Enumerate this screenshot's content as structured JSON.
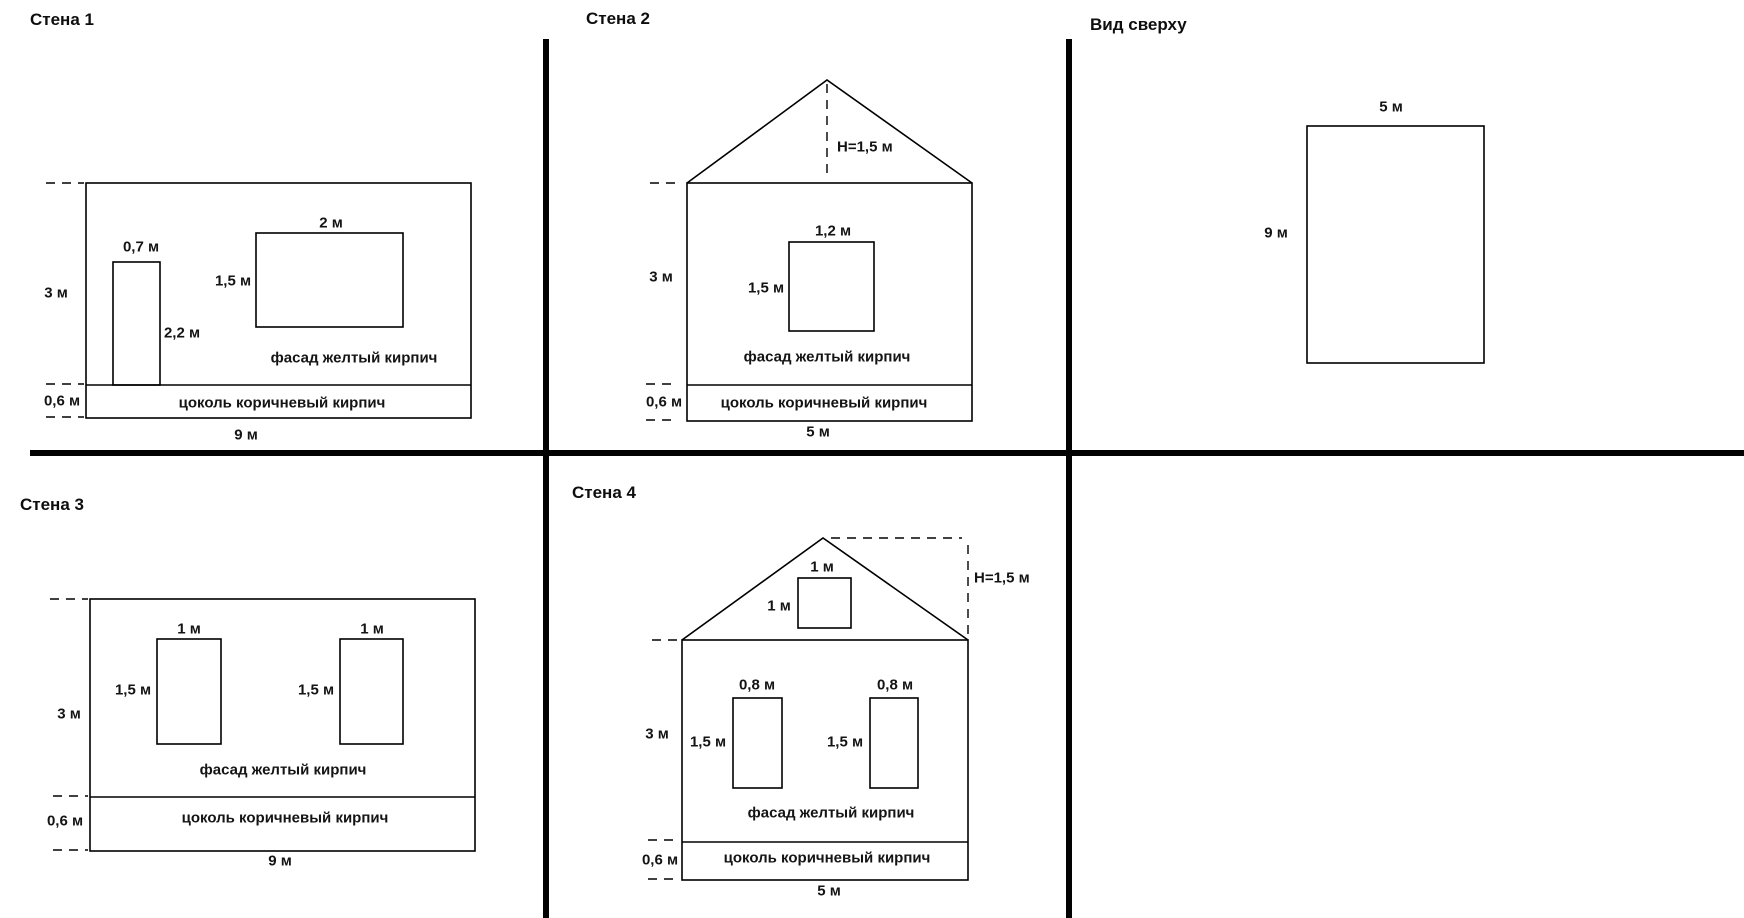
{
  "page": {
    "background": "#ffffff",
    "line_color": "#000000",
    "text_color": "#141414",
    "divider_color": "#020202"
  },
  "dividers": [
    {
      "name": "quadrant-divider-vertical-left",
      "x1": 546,
      "y1": 39,
      "x2": 546,
      "y2": 918,
      "thickness": 6
    },
    {
      "name": "quadrant-divider-vertical-right",
      "x1": 1069,
      "y1": 39,
      "x2": 1069,
      "y2": 918,
      "thickness": 6
    },
    {
      "name": "quadrant-divider-horizontal",
      "x1": 30,
      "y1": 453,
      "x2": 1744,
      "y2": 453,
      "thickness": 6
    }
  ],
  "diagrams": [
    {
      "id": "wall-1-elevation",
      "title": "Стена 1",
      "shapes": [
        {
          "type": "rect",
          "name": "wall-outline",
          "x": 86,
          "y": 183,
          "w": 385,
          "h": 235
        },
        {
          "type": "line",
          "name": "facade-plinth-divider-line",
          "x1": 86,
          "y1": 385,
          "x2": 471,
          "y2": 385
        },
        {
          "type": "rect",
          "name": "door",
          "x": 113,
          "y": 262,
          "w": 47,
          "h": 123
        },
        {
          "type": "rect",
          "name": "window",
          "x": 256,
          "y": 233,
          "w": 147,
          "h": 94
        },
        {
          "type": "line",
          "name": "dimension-tick-wall-top",
          "dashed": true,
          "x1": 46,
          "y1": 183,
          "x2": 84,
          "y2": 183
        },
        {
          "type": "line",
          "name": "dimension-tick-facade-bottom",
          "dashed": true,
          "x1": 46,
          "y1": 384,
          "x2": 84,
          "y2": 384
        },
        {
          "type": "line",
          "name": "dimension-tick-plinth-bottom",
          "dashed": true,
          "x1": 46,
          "y1": 417,
          "x2": 84,
          "y2": 417
        }
      ],
      "labels": [
        {
          "name": "door-width-label",
          "text": "0,7 м",
          "x": 141,
          "y": 247
        },
        {
          "name": "window-width-label",
          "text": "2 м",
          "x": 331,
          "y": 223
        },
        {
          "name": "window-height-label",
          "text": "1,5 м",
          "x": 233,
          "y": 281
        },
        {
          "name": "door-height-label",
          "text": "2,2 м",
          "x": 182,
          "y": 333
        },
        {
          "name": "wall-height-label",
          "text": "3 м",
          "x": 56,
          "y": 293
        },
        {
          "name": "facade-material-label",
          "text": "фасад желтый кирпич",
          "x": 354,
          "y": 358
        },
        {
          "name": "plinth-height-label",
          "text": "0,6 м",
          "x": 62,
          "y": 401
        },
        {
          "name": "plinth-material-label",
          "text": "цоколь коричневый кирпич",
          "x": 282,
          "y": 403
        },
        {
          "name": "wall-width-label",
          "text": "9 м",
          "x": 246,
          "y": 435
        }
      ]
    },
    {
      "id": "wall-2-elevation",
      "title": "Стена 2",
      "shapes": [
        {
          "type": "polyline",
          "name": "roof-outline",
          "points": "687,183 827,80 972,183"
        },
        {
          "type": "line",
          "name": "ridge-height-dashed-line",
          "dashed": true,
          "x1": 827,
          "y1": 84,
          "x2": 827,
          "y2": 180
        },
        {
          "type": "rect",
          "name": "wall-outline",
          "x": 687,
          "y": 183,
          "w": 285,
          "h": 238
        },
        {
          "type": "line",
          "name": "facade-plinth-divider-line",
          "x1": 687,
          "y1": 385,
          "x2": 972,
          "y2": 385
        },
        {
          "type": "rect",
          "name": "window",
          "x": 789,
          "y": 242,
          "w": 85,
          "h": 89
        },
        {
          "type": "line",
          "name": "dimension-tick-wall-top",
          "dashed": true,
          "x1": 650,
          "y1": 183,
          "x2": 679,
          "y2": 183
        },
        {
          "type": "line",
          "name": "dimension-tick-facade-bottom",
          "dashed": true,
          "x1": 646,
          "y1": 384,
          "x2": 675,
          "y2": 384
        },
        {
          "type": "line",
          "name": "dimension-tick-plinth-bottom",
          "dashed": true,
          "x1": 646,
          "y1": 420,
          "x2": 675,
          "y2": 420
        }
      ],
      "labels": [
        {
          "name": "ridge-height-label",
          "text": "H=1,5 м",
          "x": 837,
          "y": 147,
          "anchor": "start"
        },
        {
          "name": "window-width-label",
          "text": "1,2 м",
          "x": 833,
          "y": 231
        },
        {
          "name": "window-height-label",
          "text": "1,5 м",
          "x": 766,
          "y": 288
        },
        {
          "name": "wall-height-label",
          "text": "3 м",
          "x": 661,
          "y": 277
        },
        {
          "name": "facade-material-label",
          "text": "фасад желтый кирпич",
          "x": 827,
          "y": 357
        },
        {
          "name": "plinth-height-label",
          "text": "0,6 м",
          "x": 664,
          "y": 402
        },
        {
          "name": "plinth-material-label",
          "text": "цоколь коричневый кирпич",
          "x": 824,
          "y": 403
        },
        {
          "name": "wall-width-label",
          "text": "5 м",
          "x": 818,
          "y": 432
        }
      ]
    },
    {
      "id": "top-view-plan",
      "title": "Вид сверху",
      "shapes": [
        {
          "type": "rect",
          "name": "plan-outline",
          "x": 1307,
          "y": 126,
          "w": 177,
          "h": 237
        }
      ],
      "labels": [
        {
          "name": "plan-width-label",
          "text": "5 м",
          "x": 1391,
          "y": 107
        },
        {
          "name": "plan-length-label",
          "text": "9 м",
          "x": 1276,
          "y": 233
        }
      ]
    },
    {
      "id": "wall-3-elevation",
      "title": "Стена 3",
      "shapes": [
        {
          "type": "rect",
          "name": "wall-outline",
          "x": 90,
          "y": 599,
          "w": 385,
          "h": 252
        },
        {
          "type": "line",
          "name": "facade-plinth-divider-line",
          "x1": 90,
          "y1": 797,
          "x2": 475,
          "y2": 797
        },
        {
          "type": "rect",
          "name": "window-left",
          "x": 157,
          "y": 639,
          "w": 64,
          "h": 105
        },
        {
          "type": "rect",
          "name": "window-right",
          "x": 340,
          "y": 639,
          "w": 63,
          "h": 105
        },
        {
          "type": "line",
          "name": "dimension-tick-wall-top",
          "dashed": true,
          "x1": 50,
          "y1": 599,
          "x2": 88,
          "y2": 599
        },
        {
          "type": "line",
          "name": "dimension-tick-facade-bottom",
          "dashed": true,
          "x1": 53,
          "y1": 796,
          "x2": 88,
          "y2": 796
        },
        {
          "type": "line",
          "name": "dimension-tick-plinth-bottom",
          "dashed": true,
          "x1": 53,
          "y1": 850,
          "x2": 88,
          "y2": 850
        }
      ],
      "labels": [
        {
          "name": "window-left-width-label",
          "text": "1 м",
          "x": 189,
          "y": 629
        },
        {
          "name": "window-right-width-label",
          "text": "1 м",
          "x": 372,
          "y": 629
        },
        {
          "name": "window-left-height-label",
          "text": "1,5 м",
          "x": 133,
          "y": 690
        },
        {
          "name": "window-right-height-label",
          "text": "1,5 м",
          "x": 316,
          "y": 690
        },
        {
          "name": "wall-height-label",
          "text": "3 м",
          "x": 69,
          "y": 714
        },
        {
          "name": "facade-material-label",
          "text": "фасад желтый кирпич",
          "x": 283,
          "y": 770
        },
        {
          "name": "plinth-height-label",
          "text": "0,6 м",
          "x": 65,
          "y": 821
        },
        {
          "name": "plinth-material-label",
          "text": "цоколь коричневый кирпич",
          "x": 285,
          "y": 818
        },
        {
          "name": "wall-width-label",
          "text": "9 м",
          "x": 280,
          "y": 861
        }
      ]
    },
    {
      "id": "wall-4-elevation",
      "title": "Стена 4",
      "shapes": [
        {
          "type": "polyline",
          "name": "roof-outline",
          "points": "682,640 823,538 968,640"
        },
        {
          "type": "line",
          "name": "ridge-height-dashed-top",
          "dashed": true,
          "x1": 831,
          "y1": 538,
          "x2": 962,
          "y2": 538
        },
        {
          "type": "line",
          "name": "ridge-height-dashed-side",
          "dashed": true,
          "x1": 968,
          "y1": 545,
          "x2": 968,
          "y2": 636
        },
        {
          "type": "rect",
          "name": "wall-outline",
          "x": 682,
          "y": 640,
          "w": 286,
          "h": 240
        },
        {
          "type": "line",
          "name": "facade-plinth-divider-line",
          "x1": 682,
          "y1": 842,
          "x2": 968,
          "y2": 842
        },
        {
          "type": "rect",
          "name": "gable-window",
          "x": 798,
          "y": 578,
          "w": 53,
          "h": 50
        },
        {
          "type": "rect",
          "name": "window-left",
          "x": 733,
          "y": 698,
          "w": 49,
          "h": 90
        },
        {
          "type": "rect",
          "name": "window-right",
          "x": 870,
          "y": 698,
          "w": 48,
          "h": 90
        },
        {
          "type": "line",
          "name": "dimension-tick-wall-top",
          "dashed": true,
          "x1": 652,
          "y1": 640,
          "x2": 680,
          "y2": 640
        },
        {
          "type": "line",
          "name": "dimension-tick-facade-bottom",
          "dashed": true,
          "x1": 648,
          "y1": 840,
          "x2": 678,
          "y2": 840
        },
        {
          "type": "line",
          "name": "dimension-tick-plinth-bottom",
          "dashed": true,
          "x1": 648,
          "y1": 879,
          "x2": 678,
          "y2": 879
        }
      ],
      "labels": [
        {
          "name": "ridge-height-label",
          "text": "H=1,5 м",
          "x": 974,
          "y": 578,
          "anchor": "start"
        },
        {
          "name": "gable-window-width-label",
          "text": "1 м",
          "x": 822,
          "y": 567
        },
        {
          "name": "gable-window-height-label",
          "text": "1 м",
          "x": 779,
          "y": 606
        },
        {
          "name": "window-left-width-label",
          "text": "0,8 м",
          "x": 757,
          "y": 685
        },
        {
          "name": "window-right-width-label",
          "text": "0,8 м",
          "x": 895,
          "y": 685
        },
        {
          "name": "window-left-height-label",
          "text": "1,5 м",
          "x": 708,
          "y": 742
        },
        {
          "name": "window-right-height-label",
          "text": "1,5 м",
          "x": 845,
          "y": 742
        },
        {
          "name": "wall-height-label",
          "text": "3 м",
          "x": 657,
          "y": 734
        },
        {
          "name": "facade-material-label",
          "text": "фасад желтый кирпич",
          "x": 831,
          "y": 813
        },
        {
          "name": "plinth-height-label",
          "text": "0,6 м",
          "x": 660,
          "y": 860
        },
        {
          "name": "plinth-material-label",
          "text": "цоколь коричневый кирпич",
          "x": 827,
          "y": 858
        },
        {
          "name": "wall-width-label",
          "text": "5 м",
          "x": 829,
          "y": 891
        }
      ]
    }
  ]
}
